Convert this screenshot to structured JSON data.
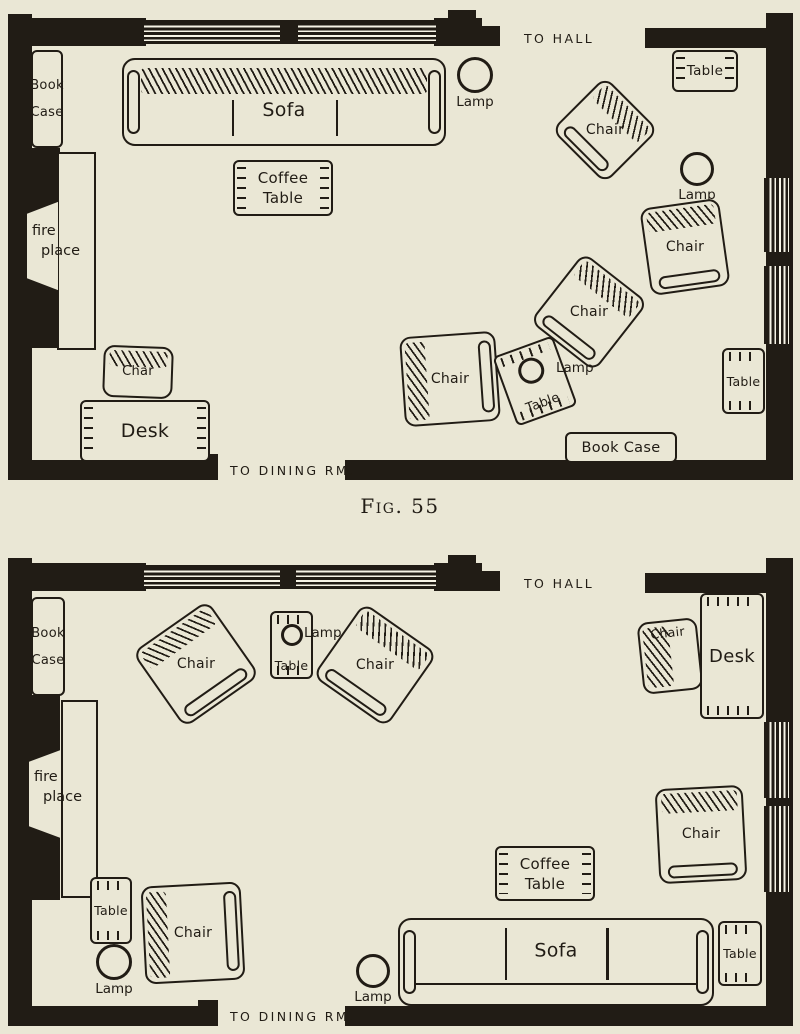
{
  "page": {
    "caption": "Fig. 55",
    "colors": {
      "paper": "#eae7d5",
      "ink": "#211c15",
      "window_stripe": "#f7f4e6"
    }
  },
  "rooms": [
    {
      "name": "living-room-plan-fig55",
      "walls": [
        [
          8,
          14,
          24,
          466
        ],
        [
          8,
          148,
          52,
          200
        ],
        [
          8,
          18,
          138,
          28
        ],
        [
          278,
          20,
          22,
          24
        ],
        [
          434,
          18,
          48,
          28
        ],
        [
          468,
          26,
          32,
          20
        ],
        [
          448,
          10,
          28,
          10
        ],
        [
          645,
          28,
          121,
          20
        ],
        [
          766,
          13,
          27,
          467
        ],
        [
          8,
          460,
          210,
          20
        ],
        [
          198,
          454,
          20,
          8
        ],
        [
          345,
          460,
          448,
          20
        ]
      ],
      "windows": [
        [
          144,
          20,
          136,
          24,
          "h"
        ],
        [
          298,
          20,
          138,
          24,
          "h"
        ],
        [
          764,
          178,
          28,
          74,
          "v"
        ],
        [
          764,
          266,
          28,
          78,
          "v"
        ]
      ],
      "furniture": [
        {
          "name": "bookcase",
          "kind": "bookcase",
          "x": 31,
          "y": 50,
          "w": 32,
          "h": 98,
          "lines": [
            "Book",
            "Case"
          ],
          "fs": 13,
          "gap": 12
        },
        {
          "name": "sofa",
          "kind": "sofa",
          "x": 122,
          "y": 58,
          "w": 324,
          "h": 88,
          "back": "top",
          "label": "Sofa",
          "labelY": 60,
          "fs": 19
        },
        {
          "name": "coffee-table",
          "kind": "table",
          "x": 233,
          "y": 160,
          "w": 100,
          "h": 56,
          "lines": [
            "Coffee",
            "Table"
          ],
          "ticks": [
            "left",
            "right"
          ],
          "fs": 15
        },
        {
          "name": "lamp",
          "kind": "lamp",
          "cx": 475,
          "cy": 75,
          "r": 18,
          "label": "Lamp"
        },
        {
          "name": "side-table",
          "kind": "table",
          "x": 672,
          "y": 50,
          "w": 66,
          "h": 42,
          "lines": [
            "Table"
          ],
          "ticks": [
            "left",
            "right"
          ],
          "fs": 13.5
        },
        {
          "name": "armchair",
          "kind": "chair",
          "x": 567,
          "y": 92,
          "w": 76,
          "h": 76,
          "rot": 45,
          "back": "top",
          "label": "Chair"
        },
        {
          "name": "lamp",
          "kind": "lamp",
          "cx": 697,
          "cy": 169,
          "r": 17,
          "label": "Lamp"
        },
        {
          "name": "armchair",
          "kind": "chair",
          "x": 645,
          "y": 203,
          "w": 80,
          "h": 88,
          "rot": -8,
          "back": "top",
          "label": "Chair"
        },
        {
          "name": "armchair",
          "kind": "chair",
          "x": 548,
          "y": 268,
          "w": 82,
          "h": 88,
          "rot": 38,
          "back": "top",
          "label": "Chair"
        },
        {
          "name": "armchair",
          "kind": "chair",
          "x": 402,
          "y": 334,
          "w": 96,
          "h": 90,
          "rot": -4,
          "back": "left",
          "label": "Chair"
        },
        {
          "name": "lamp-table",
          "kind": "table-lamp",
          "x": 503,
          "y": 344,
          "w": 64,
          "h": 74,
          "rot": -20,
          "r": 13,
          "label": "Table",
          "fs": 13
        },
        {
          "name": "side-table",
          "kind": "table",
          "x": 722,
          "y": 348,
          "w": 43,
          "h": 66,
          "lines": [
            "Table"
          ],
          "ticks": [
            "top",
            "bottom"
          ],
          "fs": 12.5
        },
        {
          "name": "bookcase",
          "kind": "table",
          "x": 565,
          "y": 432,
          "w": 112,
          "h": 31,
          "lines": [
            "Book Case"
          ],
          "ticks": [],
          "fs": 14.5
        },
        {
          "name": "fireplace",
          "kind": "fireplace",
          "hearth": [
            57,
            152,
            39,
            198
          ],
          "trap": [
            27,
            200,
            31,
            92
          ],
          "lines": [
            "fire",
            "place"
          ],
          "lx": 32,
          "ly": 222
        },
        {
          "name": "desk-chair",
          "kind": "chair",
          "x": 103,
          "y": 346,
          "w": 70,
          "h": 52,
          "rot": 2,
          "back": "top",
          "backSize": 16,
          "label": "Char",
          "fs": 13
        },
        {
          "name": "desk",
          "kind": "table",
          "x": 80,
          "y": 400,
          "w": 130,
          "h": 62,
          "lines": [
            "Desk"
          ],
          "ticks": [
            "left",
            "right"
          ],
          "fs": 19
        }
      ],
      "texts": [
        {
          "text": "TO HALL",
          "x": 524,
          "y": 31,
          "w": 120,
          "cls": "route"
        },
        {
          "text": "TO DINING RM.",
          "x": 230,
          "y": 463,
          "w": 160,
          "cls": "route"
        },
        {
          "text": "Lamp",
          "x": 556,
          "y": 360,
          "w": 60,
          "cls": "anno"
        }
      ]
    },
    {
      "name": "living-room-plan-alternate",
      "walls": [
        [
          8,
          558,
          24,
          468
        ],
        [
          8,
          695,
          52,
          205
        ],
        [
          8,
          563,
          138,
          28
        ],
        [
          278,
          565,
          20,
          24
        ],
        [
          434,
          563,
          48,
          28
        ],
        [
          468,
          571,
          32,
          20
        ],
        [
          448,
          555,
          28,
          10
        ],
        [
          645,
          573,
          121,
          20
        ],
        [
          766,
          558,
          27,
          468
        ],
        [
          8,
          1006,
          210,
          20
        ],
        [
          198,
          1000,
          20,
          8
        ],
        [
          345,
          1006,
          448,
          20
        ]
      ],
      "windows": [
        [
          144,
          565,
          136,
          24,
          "h"
        ],
        [
          296,
          565,
          140,
          24,
          "h"
        ],
        [
          764,
          722,
          28,
          76,
          "v"
        ],
        [
          764,
          806,
          28,
          86,
          "v"
        ]
      ],
      "furniture": [
        {
          "name": "bookcase",
          "kind": "bookcase",
          "x": 31,
          "y": 597,
          "w": 34,
          "h": 99,
          "lines": [
            "Book",
            "Case"
          ],
          "fs": 13,
          "gap": 12
        },
        {
          "name": "armchair",
          "kind": "chair",
          "x": 150,
          "y": 618,
          "w": 92,
          "h": 92,
          "rot": -35,
          "back": "top",
          "label": "Chair"
        },
        {
          "name": "lamp-table",
          "kind": "table-lamp",
          "x": 270,
          "y": 611,
          "w": 43,
          "h": 68,
          "rot": 0,
          "r": 11,
          "label": "Table",
          "fs": 12.5
        },
        {
          "name": "armchair",
          "kind": "chair",
          "x": 330,
          "y": 620,
          "w": 90,
          "h": 90,
          "rot": 35,
          "back": "top",
          "label": "Chair"
        },
        {
          "name": "desk-chair",
          "kind": "chair",
          "x": 640,
          "y": 620,
          "w": 60,
          "h": 72,
          "rot": -6,
          "back": "left",
          "backSize": 26,
          "label": "Chair",
          "labelPos": "top",
          "fs": 12.5
        },
        {
          "name": "desk",
          "kind": "table",
          "x": 700,
          "y": 593,
          "w": 64,
          "h": 126,
          "lines": [
            "Desk"
          ],
          "ticks": [
            "top",
            "bottom"
          ],
          "fs": 18
        },
        {
          "name": "armchair",
          "kind": "chair",
          "x": 657,
          "y": 787,
          "w": 88,
          "h": 95,
          "rot": -3,
          "back": "top",
          "label": "Chair"
        },
        {
          "name": "coffee-table",
          "kind": "table",
          "x": 495,
          "y": 846,
          "w": 100,
          "h": 55,
          "lines": [
            "Coffee",
            "Table"
          ],
          "ticks": [
            "left",
            "right"
          ],
          "fs": 15
        },
        {
          "name": "sofa",
          "kind": "sofa",
          "x": 398,
          "y": 918,
          "w": 316,
          "h": 88,
          "back": "bottom",
          "label": "Sofa",
          "labelY": 38,
          "fs": 19
        },
        {
          "name": "side-table",
          "kind": "table",
          "x": 718,
          "y": 921,
          "w": 44,
          "h": 65,
          "lines": [
            "Table"
          ],
          "ticks": [
            "top",
            "bottom"
          ],
          "fs": 12.5
        },
        {
          "name": "fireplace",
          "kind": "fireplace",
          "hearth": [
            61,
            700,
            37,
            198
          ],
          "trap": [
            29,
            748,
            32,
            92
          ],
          "lines": [
            "fire",
            "place"
          ],
          "lx": 34,
          "ly": 768
        },
        {
          "name": "side-table",
          "kind": "table",
          "x": 90,
          "y": 877,
          "w": 42,
          "h": 67,
          "lines": [
            "Table"
          ],
          "ticks": [
            "top",
            "bottom"
          ],
          "fs": 12.5
        },
        {
          "name": "lamp",
          "kind": "lamp",
          "cx": 114,
          "cy": 962,
          "r": 18,
          "label": "Lamp"
        },
        {
          "name": "armchair",
          "kind": "chair",
          "x": 143,
          "y": 884,
          "w": 100,
          "h": 98,
          "rot": -3,
          "back": "left",
          "label": "Chair"
        },
        {
          "name": "lamp",
          "kind": "lamp",
          "cx": 373,
          "cy": 971,
          "r": 17,
          "label": "Lamp"
        }
      ],
      "texts": [
        {
          "text": "TO HALL",
          "x": 524,
          "y": 576,
          "w": 120,
          "cls": "route"
        },
        {
          "text": "TO DINING RM.",
          "x": 230,
          "y": 1009,
          "w": 160,
          "cls": "route"
        },
        {
          "text": "Lamp",
          "x": 304,
          "y": 625,
          "w": 60,
          "cls": "anno"
        }
      ]
    }
  ]
}
